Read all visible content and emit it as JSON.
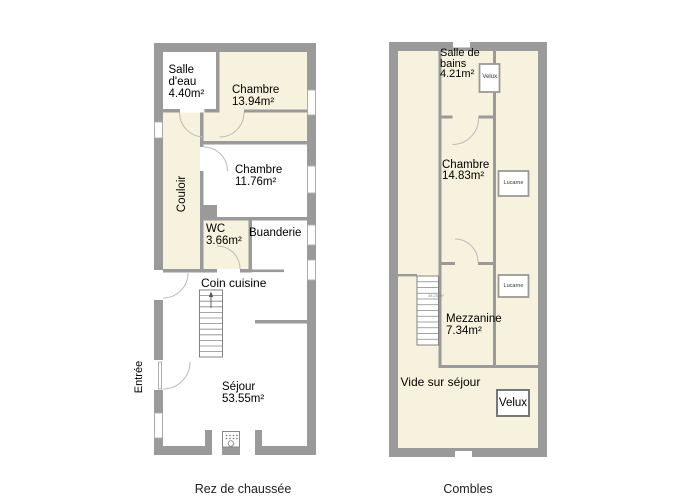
{
  "colors": {
    "wall": "#9a9a9a",
    "room_cream": "#f7f2dd",
    "room_white": "#ffffff",
    "door_arc": "#bbbbbb"
  },
  "floors": [
    {
      "name": "rez-de-chaussee",
      "caption": "Rez de chaussée",
      "outside_label": "Entrée",
      "rooms": [
        {
          "id": "salle-deau",
          "label": "Salle\nd'eau\n4.40m²"
        },
        {
          "id": "chambre-1",
          "label": "Chambre\n13.94m²"
        },
        {
          "id": "couloir",
          "label": "Couloir"
        },
        {
          "id": "chambre-2",
          "label": "Chambre\n11.76m²"
        },
        {
          "id": "wc",
          "label": "WC\n3.66m²"
        },
        {
          "id": "buanderie",
          "label": "Buanderie"
        },
        {
          "id": "coin-cuisine",
          "label": "Coin cuisine"
        },
        {
          "id": "sejour",
          "label": "Séjour\n53.55m²"
        }
      ]
    },
    {
      "name": "combles",
      "caption": "Combles",
      "rooms": [
        {
          "id": "salle-de-bains",
          "label": "Salle de\nbains\n4.21m²"
        },
        {
          "id": "chambre-3",
          "label": "Chambre\n14.83m²"
        },
        {
          "id": "mezzanine",
          "label": "Mezzanine\n7.34m²"
        },
        {
          "id": "vide-sur-sejour",
          "label": "Vide sur séjour"
        }
      ],
      "windows": [
        {
          "id": "velux-top",
          "label": "Velux"
        },
        {
          "id": "lucarne-1",
          "label": "Lucarne"
        },
        {
          "id": "lucarne-2",
          "label": "Lucarne"
        },
        {
          "id": "velux-bottom",
          "label": "Velux"
        }
      ],
      "stairs_note": "38.25 m²"
    }
  ]
}
